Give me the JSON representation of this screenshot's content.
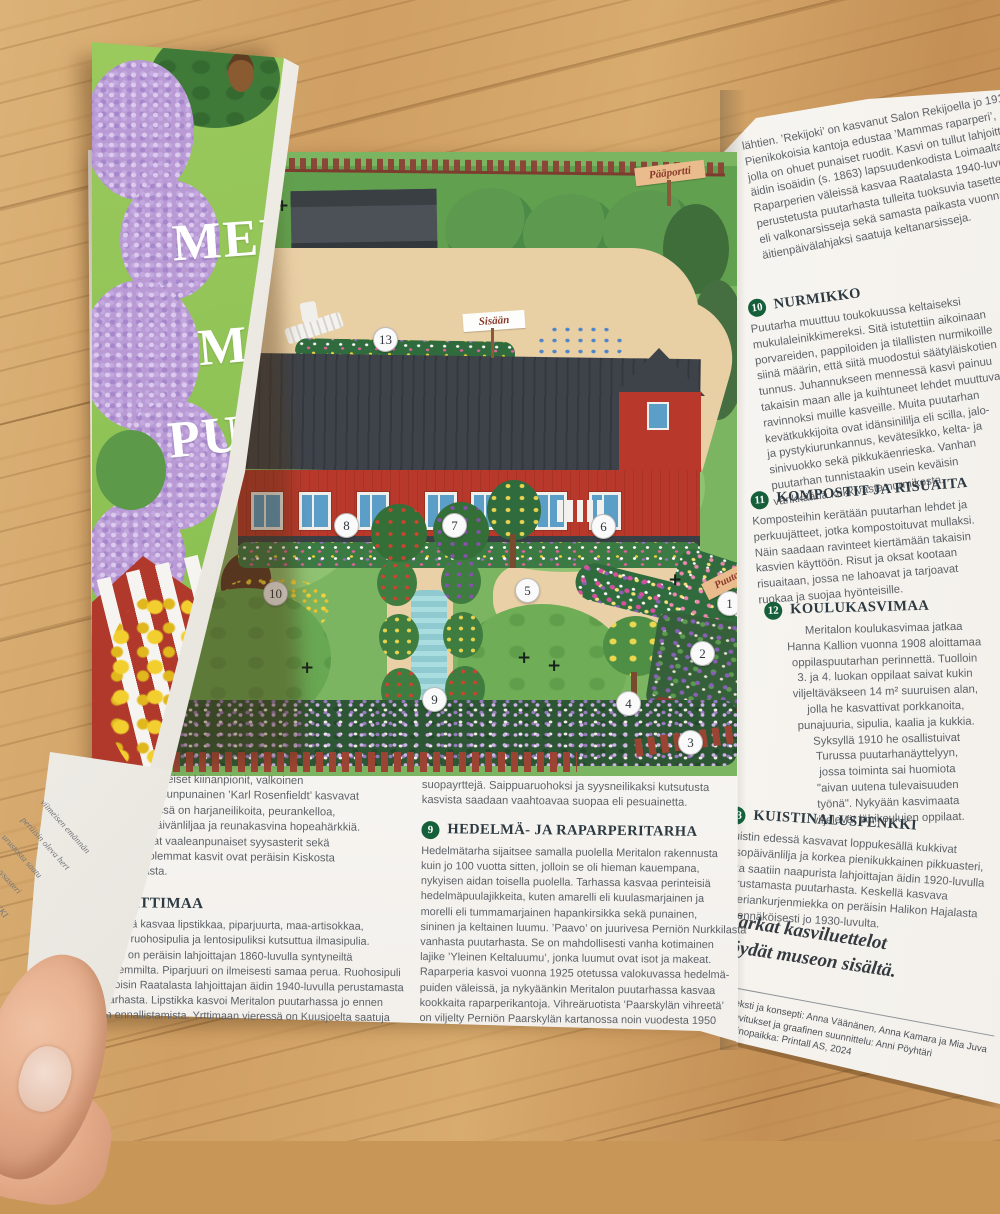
{
  "cover": {
    "title_lines": [
      "MERIT",
      "MUS",
      "PUUT"
    ]
  },
  "map": {
    "signs": {
      "gate": "Pääportti",
      "entrance": "Sisään",
      "garden": "Puutarhaan"
    },
    "markers": [
      {
        "n": "1",
        "x": 633,
        "y": 450
      },
      {
        "n": "2",
        "x": 606,
        "y": 500
      },
      {
        "n": "3",
        "x": 594,
        "y": 589
      },
      {
        "n": "4",
        "x": 532,
        "y": 550
      },
      {
        "n": "5",
        "x": 431,
        "y": 437
      },
      {
        "n": "6",
        "x": 507,
        "y": 373
      },
      {
        "n": "7",
        "x": 358,
        "y": 372
      },
      {
        "n": "8",
        "x": 250,
        "y": 372
      },
      {
        "n": "9",
        "x": 338,
        "y": 546
      },
      {
        "n": "10",
        "x": 179,
        "y": 440
      },
      {
        "n": "13",
        "x": 289,
        "y": 186
      }
    ],
    "plus_marks": [
      {
        "x": 180,
        "y": 44
      },
      {
        "x": 205,
        "y": 506
      },
      {
        "x": 422,
        "y": 496
      },
      {
        "x": 452,
        "y": 504
      },
      {
        "x": 573,
        "y": 418
      }
    ]
  },
  "center_columns": {
    "left": {
      "para1_lines": [
        "alasta. Perinteiset kiinanpionit, valkoinen",
        "’kima’ ja ruusunpunainen ’Karl Rosenfieldt’ kasvavat",
        "nassa. Edessä on harjaneilikoita, peurankelloa,",
        "o- ja keltapäivänliljaa ja reunakasvina hopeahärkkiä.",
        "asti kukkivat vaaleanpunaiset syysasterit sekä",
        "piiskut. Molemmat kasvit ovat peräisin Kiskosta",
        "talon pihasta."
      ],
      "heading": "RTTIMAA",
      "para2_lines": [
        "enkissä kasvaa lipstikkaa, piparjuurta, maa-artisokkaa,",
        "unaa, ruohosipulia ja lentosipuliksi kutsuttua ilmasipulia.",
        "sipuli on peräisin lahjoittajan 1860-luvulla syntyneiltä",
        "anhemmilta. Piparjuuri on ilmeisesti samaa perua. Ruohosipuli",
        "kotoisin Raatalasta lahjoittajan äidin 1940-luvulla perustamasta",
        "utarhasta. Lipstikka kasvoi Meritalon puutarhassa jo ennen",
        "en ennallistamista. Yrttimaan vieressä on Kuusjoelta saatuja"
      ]
    },
    "middle": {
      "para0_lines": [
        "suopayrttejä. Saippuaruohoksi ja syysneilikaksi kutsutusta",
        "kasvista saadaan vaahtoavaa suopaa eli pesuainetta."
      ],
      "section9_num": "9",
      "section9_title": "HEDELMÄ- JA RAPARPERITARHA",
      "section9_lines": [
        "Hedelmätarha sijaitsee samalla puolella Meritalon rakennusta",
        "kuin jo 100 vuotta sitten, jolloin se oli hieman kauempana,",
        "nykyisen aidan toisella puolella. Tarhassa kasvaa perinteisiä",
        "hedelmäpuulajikkeita, kuten amarelli eli kuulasmarjainen ja",
        "morelli eli tummamarjainen hapankirsikka sekä punainen,",
        "sininen ja keltainen luumu. ’Paavo’ on juurivesa Perniön Nurkkilasta",
        "vanhasta puutarhasta. Se on mahdollisesti vanha kotimainen",
        "lajike ’Yleinen Keltaluumu’, jonka luumut ovat isot ja makeat.",
        "    Raparperia kasvoi vuonna 1925 otetussa valokuvassa hedelmä-",
        "puiden väleissä, ja nykyäänkin Meritalon puutarhassa kasvaa",
        "kookkaita raparperikantoja. Vihreäruotista ’Paarskylän vihreetä’",
        "on viljelty Perniön Paarskylän kartanossa noin vuodesta 1950"
      ]
    }
  },
  "right_page": {
    "intro_lines": [
      "lähtien. ’Rekijoki’ on kasvanut Salon Rekijoella jo 1910-luvulla.",
      "Pienikokoisia kantoja edustaa ’Mammas raparperi’,",
      "jolla on ohuet punaiset ruodit. Kasvi on tullut lahjoittajan",
      "äidin isoäidin (s. 1863) lapsuudenkodista Loimaalta.",
      "Raparperien väleissä kasvaa Raatalasta 1940-luvulla",
      "perustetusta puutarhasta tulleita tuoksuvia tasetteja",
      "eli valkonarsisseja sekä samasta paikasta vuonna 1965",
      "äitienpäivälahjaksi saatuja keltanarsisseja."
    ],
    "sections": {
      "s10": {
        "num": "10",
        "title": "NURMIKKO",
        "lines": [
          "Puutarha muuttuu toukokuussa keltaiseksi",
          "mukulaleinikkimereksi. Sitä istutettiin aikoinaan",
          "porvareiden, pappiloiden ja tilallisten nurmikoille",
          "siinä määrin, että siitä muodostui säätyläiskotien",
          "tunnus. Juhannukseen mennessä kasvi painuu",
          "takaisin maan alle ja kuihtuneet lehdet muuttuvat",
          "ravinnoksi muille kasveille. Muita puutarhan",
          "kevätkukkijoita ovat idänsinililja eli scilla, jalo-",
          "ja pystykiurunkannus, kevätesikko, kelta- ja",
          "sinivuokko sekä pikkukäenrieska. Vanhan",
          "puutarhan tunnistaakin usein keväisin",
          "värikkäänä kukkivasta nurmikosta."
        ]
      },
      "s11": {
        "num": "11",
        "title": "KOMPOSTIT JA RISUAITA",
        "lines": [
          "Komposteihin kerätään puutarhan lehdet ja",
          "perkuujätteet, jotka kompostoituvat mullaksi.",
          "Näin saadaan ravinteet kiertämään takaisin",
          "kasvien käyttöön. Risut ja oksat kootaan",
          "risuaitaan, jossa ne lahoavat ja tarjoavat",
          "ruokaa ja suojaa hyönteisille."
        ]
      },
      "s12": {
        "num": "12",
        "title": "KOULUKASVIMAA",
        "lines": [
          "Meritalon koulukasvimaa jatkaa",
          "Hanna Kallion vuonna 1908 aloittamaa",
          "oppilaspuutarhan perinnettä. Tuolloin",
          "3. ja 4. luokan oppilaat saivat kukin",
          "viljeltäväkseen 14 m² suuruisen alan,",
          "jolla he kasvattivat porkkanoita,",
          "punajuuria, sipulia, kaalia ja kukkia.",
          "Syksyllä 1910 he osallistuivat",
          "Turussa puutarhanäyttelyyn,",
          "jossa toiminta sai huomiota",
          "\"aivan uutena tulevaisuuden",
          "työnä\". Nykyään kasvimaata",
          "viljelevät lähikoulujen oppilaat."
        ]
      },
      "s13": {
        "num": "13",
        "title": "KUISTINALUSPENKKI",
        "lines": [
          "Kuistin edessä kasvavat loppukesällä kukkivat",
          "rusopäivänlilja ja korkea pienikukkainen pikkuasteri,",
          "joka saatiin naapurista lahjoittajan äidin 1920-luvulla",
          "perustamasta puutarhasta. Keskellä kasvava",
          "siperiankurjenmiekka on peräisin Halikon Hajalasta",
          "todennäköisesti jo 1930-luvulta."
        ]
      }
    },
    "note_lines": [
      "Tarkat kasviluettelot",
      "löydät museon sisältä."
    ],
    "credits_lines": [
      "Teksti ja konsepti: Anna Väänänen, Anna Kamara ja Mia Juva",
      "Kuvitukset ja graafinen suunnittelu: Anni Pöyhtäri",
      "Painopaikka: Printall AS, 2024"
    ]
  },
  "curl_fragments": [
    "viimeisen emännän",
    "peräisin oleva hert",
    "urustosta saatu",
    "inen syysasteri",
    "KUKKAPENKKI",
    "sta kukkivat",
    "tapallot. Edessä"
  ],
  "colors": {
    "accent_green": "#15603a",
    "building_red": "#b8392c",
    "roof_gray": "#3e434a",
    "path_sand": "#e9cfa4",
    "grass": "#7cb561",
    "cover_green": "#8cc153",
    "lilac_purple": "#b99ad4",
    "wood": "#cf9f63"
  }
}
